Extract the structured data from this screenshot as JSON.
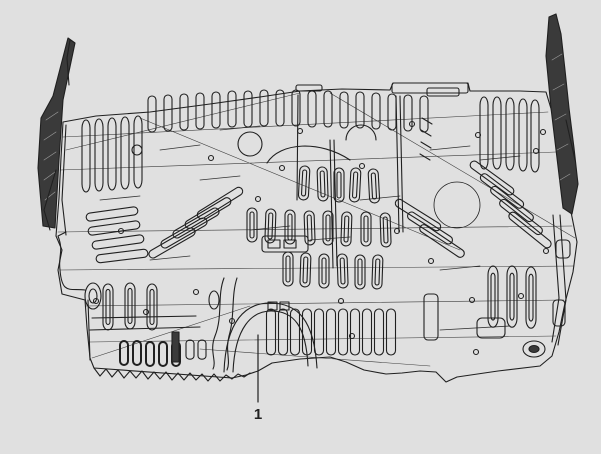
{
  "figure": {
    "type": "technical-parts-diagram",
    "callouts": [
      {
        "label": "1"
      }
    ],
    "colors": {
      "background": "#e0e0e0",
      "line": "#202020",
      "fill_dark": "#3a3a3a",
      "hatch": "#9a9a9a"
    }
  }
}
